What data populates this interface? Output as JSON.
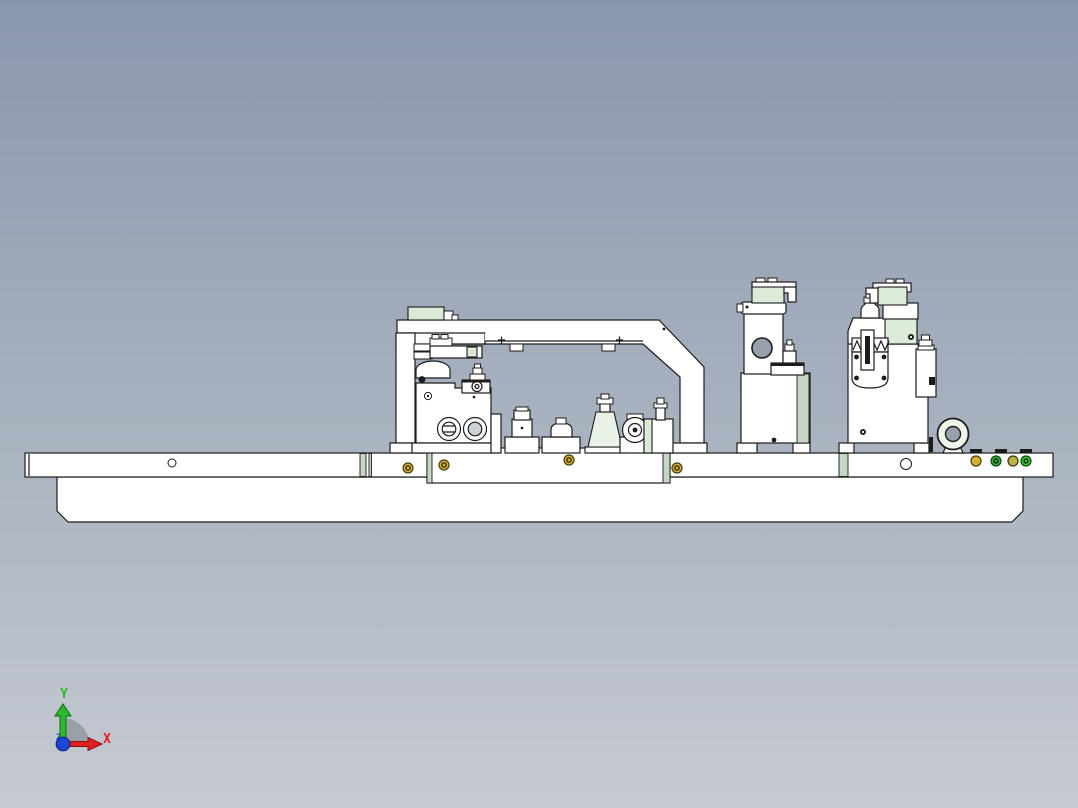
{
  "viewport": {
    "kind": "CAD 3D viewport",
    "model_description": "Side elevation view of a machining fixture / clamping jig assembly mounted on a long stepped base plate"
  },
  "axis_triad": {
    "x_label": "X",
    "y_label": "Y",
    "z_label": "Z"
  },
  "colors": {
    "bg_top": "#8997ad",
    "bg_bottom": "#c6cad2",
    "part": "#ffffff",
    "part_shade": "#e7eaec",
    "green_tint": "#dcead8",
    "green_pale": "#e9f2e6",
    "green_strip": "#c5d6c5",
    "outline": "#1c1c1c",
    "hole_gray": "#97a1ab",
    "axis_x": "#e02020",
    "axis_y": "#2db92d",
    "axis_z": "#1b46d6",
    "arc_gray": "#9aa0a8",
    "screw_yellow": "#d4af35",
    "dot_green": "#2fae2f",
    "dot_bright_green": "#38c531",
    "dot_olive": "#b9b04a"
  },
  "parts": [
    "base-plate",
    "sub-plate",
    "gooseneck-arm",
    "left-fixture-block",
    "center-locators",
    "left-clamp-tower",
    "right-clamp-tower",
    "lifting-ring",
    "indicator-dots",
    "origin-triad"
  ]
}
